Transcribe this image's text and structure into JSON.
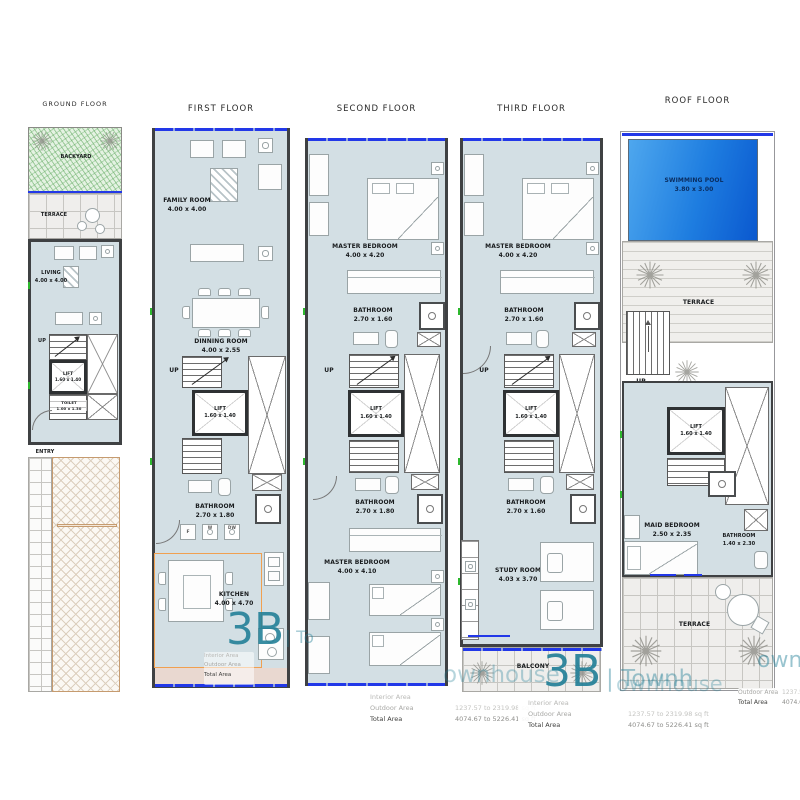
{
  "titles": {
    "ground": "GROUND FLOOR",
    "first": "FIRST FLOOR",
    "second": "SECOND FLOOR",
    "third": "THIRD FLOOR",
    "roof": "ROOF FLOOR"
  },
  "ground": {
    "backyard": "BACKYARD",
    "terrace": "TERRACE",
    "living": "LIVING",
    "living_dim": "4.00 x 4.00",
    "up": "UP",
    "lift": "LIFT",
    "lift_dim": "1.60 x 1.40",
    "toilet": "TOILET",
    "toilet_dim": "1.00 x 1.30",
    "entry": "ENTRY"
  },
  "first": {
    "family_room": "FAMILY ROOM",
    "family_room_dim": "4.00 x 4.00",
    "dinning_room": "DINNING ROOM",
    "dinning_room_dim": "4.00 x 2.55",
    "up": "UP",
    "lift": "LIFT",
    "lift_dim": "1.60 x 1.40",
    "bathroom": "BATHROOM",
    "bathroom_dim": "2.70 x 1.80",
    "kitchen": "KITCHEN",
    "kitchen_dim": "4.00 x 4.70",
    "appliance_f": "F",
    "appliance_w": "W",
    "appliance_dw": "DW"
  },
  "second": {
    "master_bedroom_1": "MASTER BEDROOM",
    "master_bedroom_1_dim": "4.00 x 4.20",
    "bathroom_1": "BATHROOM",
    "bathroom_1_dim": "2.70 x 1.60",
    "up": "UP",
    "lift": "LIFT",
    "lift_dim": "1.60 x 1.40",
    "bathroom_2": "BATHROOM",
    "bathroom_2_dim": "2.70 x 1.80",
    "master_bedroom_2": "MASTER BEDROOM",
    "master_bedroom_2_dim": "4.00 x 4.10"
  },
  "third": {
    "master_bedroom": "MASTER BEDROOM",
    "master_bedroom_dim": "4.00 x 4.20",
    "bathroom_1": "BATHROOM",
    "bathroom_1_dim": "2.70 x 1.60",
    "up": "UP",
    "lift": "LIFT",
    "lift_dim": "1.60 x 1.40",
    "bathroom_2": "BATHROOM",
    "bathroom_2_dim": "2.70 x 1.60",
    "study_room": "STUDY ROOM",
    "study_room_dim": "4.03 x 3.70",
    "balcony": "BALCONY"
  },
  "roof": {
    "swimming_pool": "SWIMMING POOL",
    "swimming_pool_dim": "3.80 x 3.00",
    "terrace_upper": "TERRACE",
    "up": "UP",
    "lift": "LIFT",
    "lift_dim": "1.60 x 1.40",
    "maid_bedroom": "MAID BEDROOM",
    "maid_bedroom_dim": "2.50 x 2.35",
    "bathroom": "BATHROOM",
    "bathroom_dim": "1.40 x 2.30",
    "terrace_lower": "TERRACE"
  },
  "area_table": {
    "rows": [
      {
        "label": "Interior Area",
        "value": ""
      },
      {
        "label": "Outdoor Area",
        "value": "1237.57 to 2319.98 sq ft"
      },
      {
        "label": "Total Area",
        "value": "4074.67 to 5226.41 sq ft"
      }
    ]
  },
  "watermark": {
    "badge": "3B",
    "frag_to": "| To",
    "frag_ownhouse": "ownhouse",
    "frag_townh": "| Townh",
    "frag_ownh": "ownh",
    "color": "#1f7e96"
  },
  "colors": {
    "wall": "#3f4143",
    "interior_fill": "#d3dfe4",
    "window_blue": "#2238e8",
    "backyard_green": "#7cc47c",
    "driveway_tan": "#c69b6f",
    "pool_blue_dark": "#0a58cf",
    "pool_blue_light": "#4ea7ee",
    "kitchen_accent_orange": "#f0a050",
    "watermark_teal": "#1f7e96",
    "band_pink": "#e9d8d0"
  }
}
